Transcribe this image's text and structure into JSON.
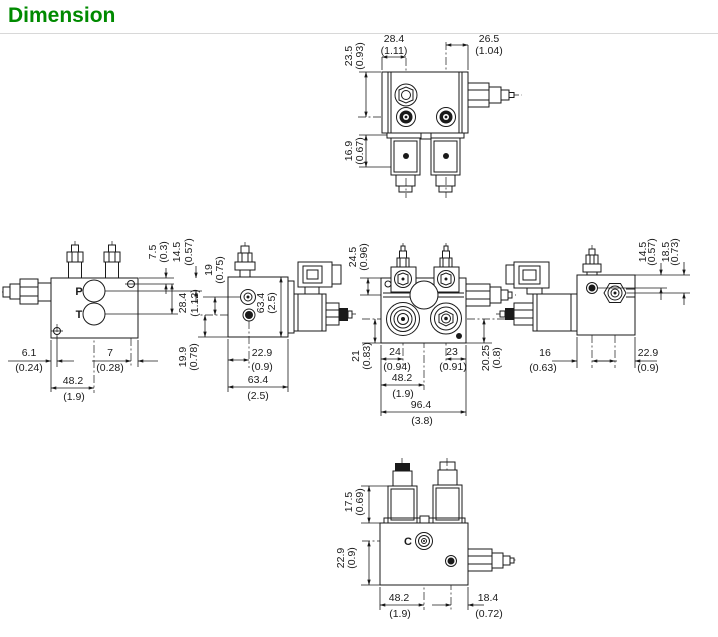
{
  "title": {
    "text": "Dimension",
    "color": "#008A00"
  },
  "views": {
    "top": {
      "dims": {
        "width_left": {
          "mm": "28.4",
          "inch": "(1.11)"
        },
        "width_right": {
          "mm": "26.5",
          "inch": "(1.04)"
        },
        "height_upper": {
          "mm": "23.5",
          "inch": "(0.93)"
        },
        "coil_height": {
          "mm": "16.9",
          "inch": "(0.67)"
        }
      }
    },
    "left_side": {
      "ports": {
        "p": "P",
        "t": "T"
      },
      "dims": {
        "hole_top": {
          "mm": "7.5",
          "inch": "(0.3)"
        },
        "port_p_depth": {
          "mm": "14.5",
          "inch": "(0.57)"
        },
        "port_t_depth": {
          "mm": "28.4",
          "inch": "(1.12)"
        },
        "hole_left": {
          "mm": "6.1",
          "inch": "(0.24)"
        },
        "hole_right": {
          "mm": "7",
          "inch": "(0.28)"
        },
        "port_center": {
          "mm": "48.2",
          "inch": "(1.9)"
        }
      }
    },
    "side_b": {
      "dims": {
        "port_top": {
          "mm": "19",
          "inch": "(0.75)"
        },
        "height": {
          "mm": "63.4",
          "inch": "(2.5)"
        },
        "port_bottom": {
          "mm": "19.9",
          "inch": "(0.78)"
        },
        "port_left": {
          "mm": "22.9",
          "inch": "(0.9)"
        },
        "depth": {
          "mm": "63.4",
          "inch": "(2.5)"
        }
      }
    },
    "front": {
      "dims": {
        "top_to_axis": {
          "mm": "24.5",
          "inch": "(0.96)"
        },
        "axis_bottom_l": {
          "mm": "21",
          "inch": "(0.83)"
        },
        "port_a": {
          "mm": "24",
          "inch": "(0.94)"
        },
        "port_b": {
          "mm": "23",
          "inch": "(0.91)"
        },
        "axis_bottom_r": {
          "mm": "20.25",
          "inch": "(0.8)"
        },
        "half_width": {
          "mm": "48.2",
          "inch": "(1.9)"
        },
        "width": {
          "mm": "96.4",
          "inch": "(3.8)"
        }
      }
    },
    "right_side": {
      "dims": {
        "screw_depth": {
          "mm": "14.5",
          "inch": "(0.57)"
        },
        "port_depth": {
          "mm": "18.5",
          "inch": "(0.73)"
        },
        "screw_offset": {
          "mm": "16",
          "inch": "(0.63)"
        },
        "port_offset": {
          "mm": "22.9",
          "inch": "(0.9)"
        }
      }
    },
    "bottom": {
      "port_label": "C",
      "dims": {
        "coil_height": {
          "mm": "17.5",
          "inch": "(0.69)"
        },
        "port_to_edge": {
          "mm": "22.9",
          "inch": "(0.9)"
        },
        "port_center": {
          "mm": "48.2",
          "inch": "(1.9)"
        },
        "outlet_offset": {
          "mm": "18.4",
          "inch": "(0.72)"
        }
      }
    }
  }
}
